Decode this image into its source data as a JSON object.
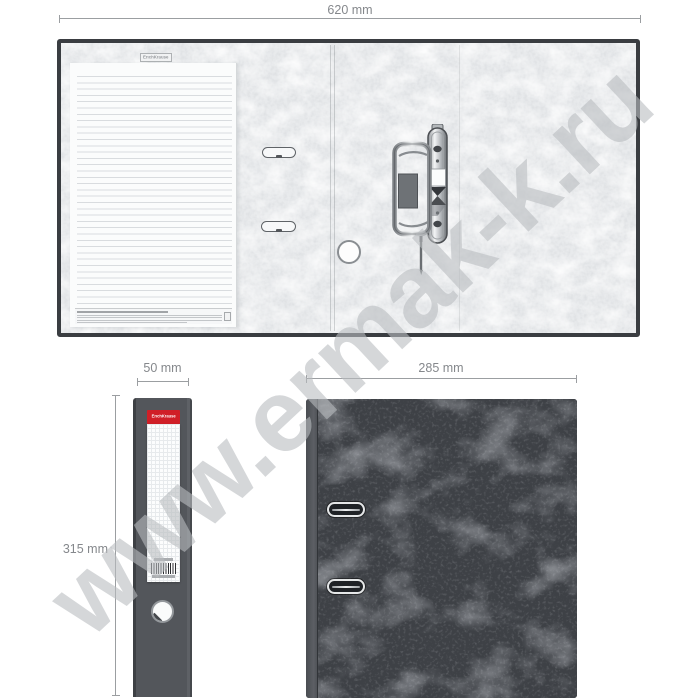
{
  "product": {
    "type": "lever arch file — technical dimension views",
    "brand": "ErichKrause"
  },
  "watermark": {
    "text": "www.ermak-k.ru"
  },
  "dimensions": {
    "open_width": "620 mm",
    "spine_width": "50 mm",
    "height": "315 mm",
    "cover_width": "285 mm"
  },
  "open_view": {
    "stamp_text": "ErichKrause"
  },
  "spine_view": {
    "brand_label": "ErichKrause"
  },
  "icons": {
    "barcode": "barcode-icon",
    "finger_hole": "round-hole",
    "eyelet": "metal-eyelet-slot",
    "mechanism": "lever-arch-mechanism"
  },
  "colors": {
    "accent_red": "#d01f27",
    "binder_border": "#3a3d41",
    "spine_gray": "#53565b",
    "cover_gray": "#3e4146",
    "dimension_line": "#9b9ea1",
    "dimension_text": "#85888c",
    "watermark_gray": "rgba(185,188,192,0.6)"
  }
}
